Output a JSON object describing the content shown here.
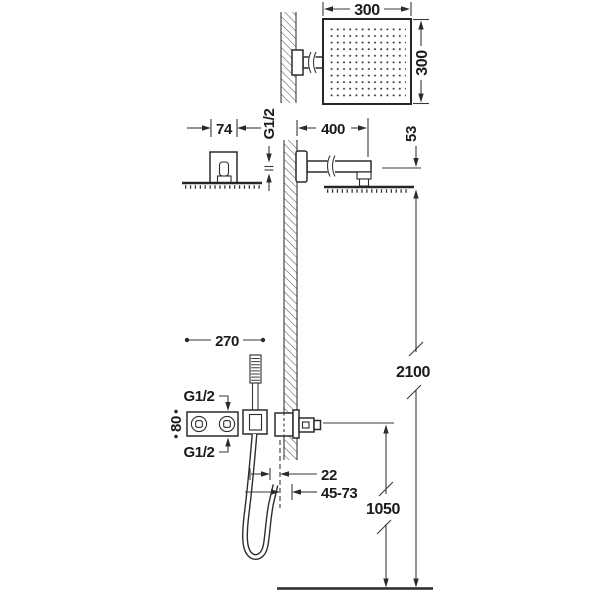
{
  "dims": {
    "head_width": "300",
    "head_depth": "300",
    "escutcheon_width": "74",
    "arm_thread": "G1/2",
    "arm_length": "400",
    "head_drop": "53",
    "mixer_offset": "270",
    "mixer_top_thread": "G1/2",
    "mixer_height": "80",
    "mixer_bottom_thread": "G1/2",
    "holder_offset": "22",
    "outlet_range": "45-73",
    "outlet_height": "1050",
    "head_height": "2100"
  }
}
